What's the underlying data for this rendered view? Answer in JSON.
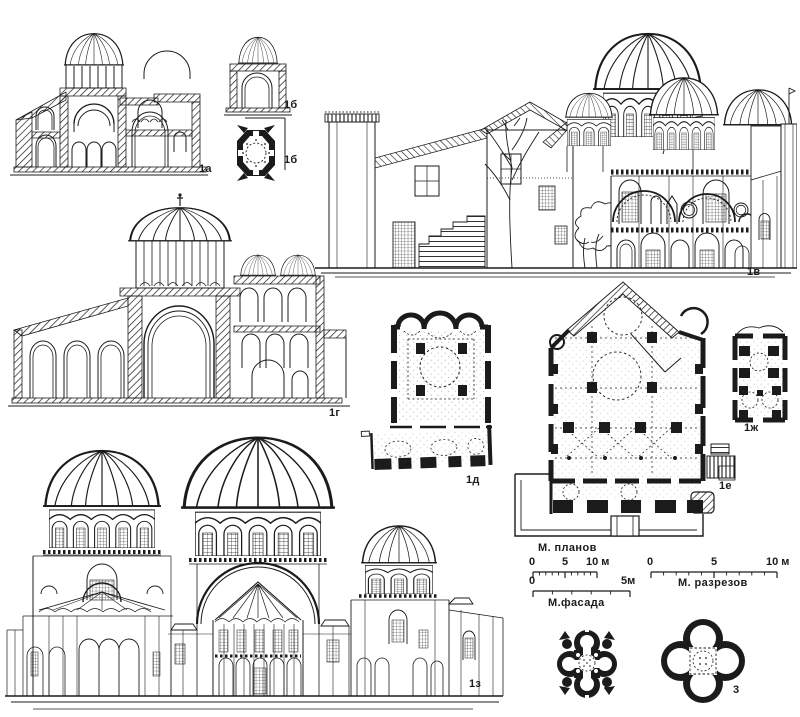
{
  "page": {
    "background": "#ffffff",
    "ink": "#1b1b1b"
  },
  "drawings": [
    {
      "id": "section-1a",
      "kind": "cross-section",
      "label": "1а"
    },
    {
      "id": "section-1b",
      "kind": "cross-section",
      "label": "1б"
    },
    {
      "id": "plan-1b",
      "kind": "plan",
      "label": "1б"
    },
    {
      "id": "elevation-1v",
      "kind": "elevation",
      "label": "1в"
    },
    {
      "id": "section-1g",
      "kind": "cross-section",
      "label": "1г"
    },
    {
      "id": "plan-1d",
      "kind": "plan",
      "label": "1д"
    },
    {
      "id": "plan-1e",
      "kind": "plan",
      "label": "1е"
    },
    {
      "id": "plan-1zh",
      "kind": "plan",
      "label": "1ж"
    },
    {
      "id": "elevation-1z",
      "kind": "elevation",
      "label": "1з"
    },
    {
      "id": "plan-2",
      "kind": "plan",
      "label": "2"
    },
    {
      "id": "plan-3",
      "kind": "plan",
      "label": "3"
    }
  ],
  "scale_bars": [
    {
      "title": "М. планов",
      "ticks": [
        "0",
        "5",
        "10 м"
      ]
    },
    {
      "title": "М.фасада",
      "ticks": [
        "0",
        "5м"
      ]
    },
    {
      "title": "М. разрезов",
      "ticks": [
        "0",
        "5",
        "10 м"
      ]
    }
  ]
}
